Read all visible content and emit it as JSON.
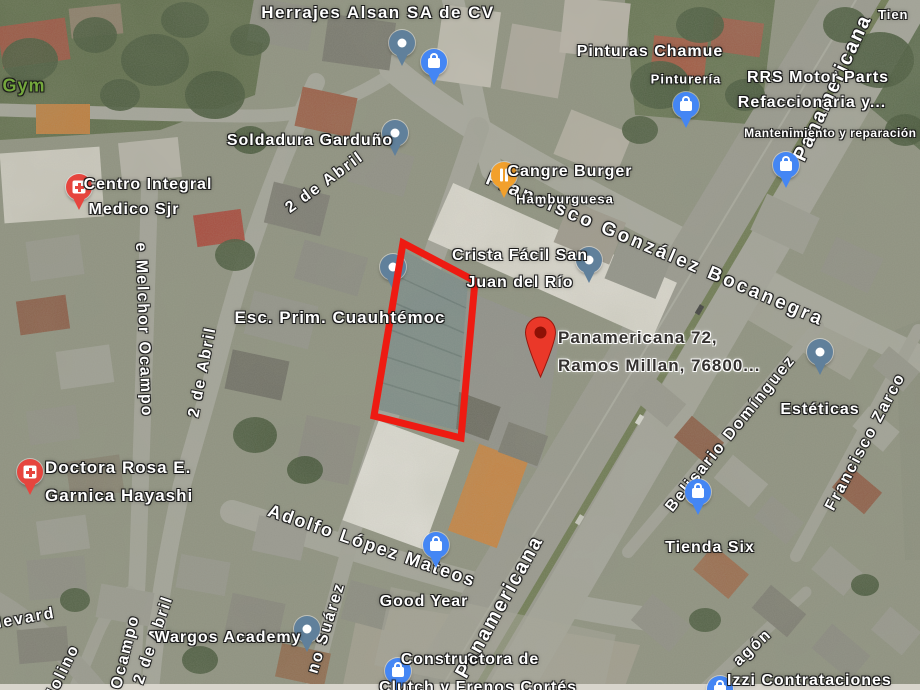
{
  "map": {
    "view": "satellite",
    "location_hint": "San Juan del Río area street map"
  },
  "colors": {
    "shop_pin": "#4486f4",
    "generic_pin": "#60809b",
    "medical_pin": "#e6453e",
    "food_pin": "#f2a02c",
    "destination_marker": "#ea3829",
    "property_outline": "#ee1b12",
    "street_label": "#ffffff",
    "gym_label": "#74a73c",
    "boulevard_label": "#a8569d",
    "address_label": "#33302e"
  },
  "pin_types": {
    "shop": "shopping-bag-icon",
    "generic": "dot-icon",
    "medical": "hospital-cross-icon",
    "food": "restaurant-fork-knife-icon",
    "destination": "red-location-pin-icon"
  },
  "places": [
    {
      "name": "Herrajes Alsan SA de CV"
    },
    {
      "name": "Gym"
    },
    {
      "line1": "Centro Integral",
      "line2": "Medico Sjr"
    },
    {
      "name": "Soldadura Garduño"
    },
    {
      "line1": "Pinturas Chamue",
      "line2": "Pinturería"
    },
    {
      "line1": "RRS Motor Parts",
      "line2": "Refaccionaria y...",
      "line3": "Mantenimiento y reparación ..."
    },
    {
      "line1": "Cangre Burger",
      "line2": "Hamburguesa"
    },
    {
      "line1": "Crista Fácil San",
      "line2": "Juan del Río"
    },
    {
      "name": "Esc. Prim. Cuauhtémoc"
    },
    {
      "line1": "Panamericana 72,",
      "line2": "Ramos Millan, 76800..."
    },
    {
      "name": "Estéticas"
    },
    {
      "line1": "Doctora Rosa E.",
      "line2": "Garnica Hayashi"
    },
    {
      "name": "Tienda Six"
    },
    {
      "name": "Wargos Academy"
    },
    {
      "name": "Good Year"
    },
    {
      "line1": "Constructora de",
      "line2": "Clutch y Frenos Cortés"
    },
    {
      "name": "Izzi Contrataciones"
    },
    {
      "name": "Tien"
    }
  ],
  "streets": [
    {
      "name": "Panamericana"
    },
    {
      "name": "Francisco González Bocanegra"
    },
    {
      "name": "2 de Abril"
    },
    {
      "name": "2 de Abril"
    },
    {
      "name": "e Melchor Ocampo"
    },
    {
      "name": "Adolfo López Mateos"
    },
    {
      "name": "no Suárez"
    },
    {
      "name": "Belisario Domínguez"
    },
    {
      "name": "Francisco Zarco"
    },
    {
      "name": "Panamericana"
    },
    {
      "name": "2 de Abril"
    },
    {
      "name": "Ocampo"
    },
    {
      "name": "Molino"
    },
    {
      "name": "Boulevard"
    },
    {
      "name": "agón"
    }
  ]
}
